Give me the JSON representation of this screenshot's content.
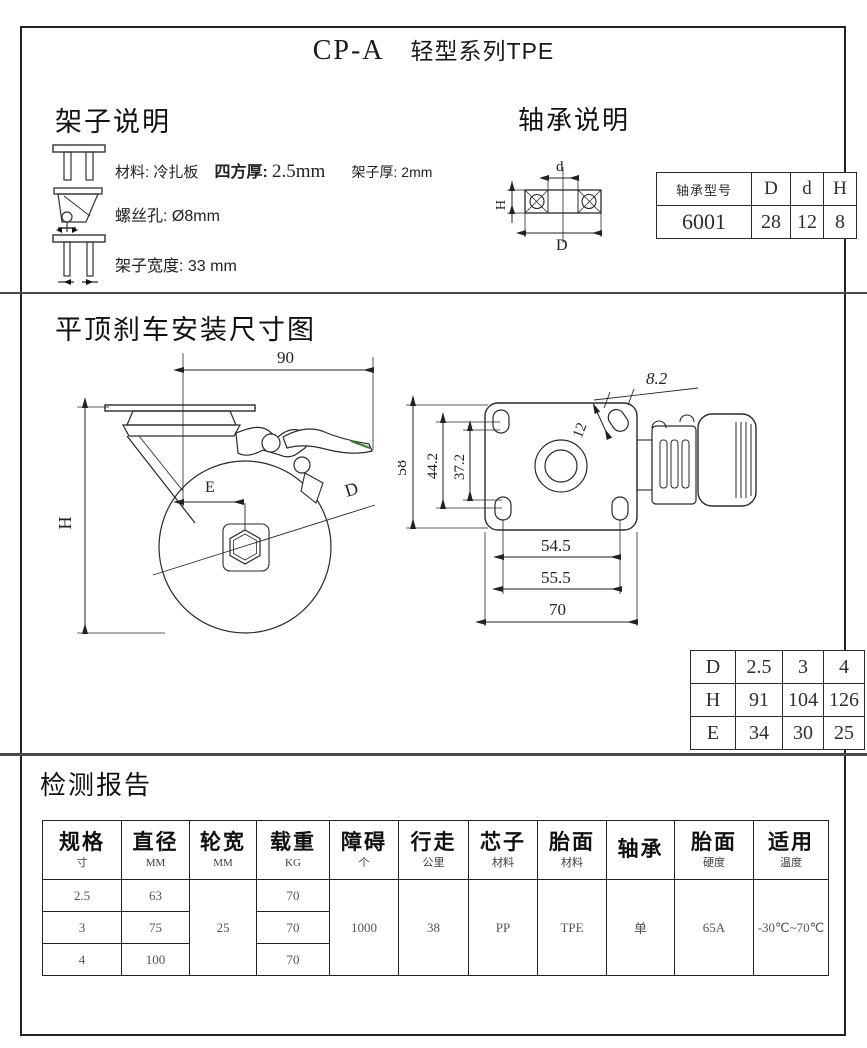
{
  "page": {
    "code": "CP-A",
    "series": "轻型系列TPE"
  },
  "frame": {
    "heading": "架子说明",
    "material_label": "材料: 冷扎板",
    "square_thickness_label": "四方厚:",
    "square_thickness_value": "2.5mm",
    "frame_thickness": "架子厚: 2mm",
    "screw_hole": "螺丝孔: Ø8mm",
    "frame_width": "架子宽度: 33 mm"
  },
  "bearing": {
    "heading": "轴承说明",
    "diagram": {
      "d": "d",
      "D": "D",
      "H": "H"
    },
    "table": {
      "model_header": "轴承型号",
      "col_D": "D",
      "col_d": "d",
      "col_H": "H",
      "model": "6001",
      "D_value": "28",
      "d_value": "12",
      "H_value": "8"
    }
  },
  "drawing": {
    "heading": "平顶刹车安装尺寸图",
    "side_view": {
      "width": "90",
      "height_label": "H",
      "offset_label": "E",
      "diameter_label": "D"
    },
    "top_view": {
      "plate_height": "58",
      "bolt_span_outer": "44.2",
      "bolt_span_inner": "37.2",
      "slot_length": "12",
      "slot_width": "8.2",
      "bolt_pitch_inner": "54.5",
      "bolt_pitch_outer": "55.5",
      "plate_width": "70"
    },
    "dhe_table": {
      "row_d": {
        "label": "D",
        "c1": "2.5",
        "c2": "3",
        "c3": "4"
      },
      "row_h": {
        "label": "H",
        "c1": "91",
        "c2": "104",
        "c3": "126"
      },
      "row_e": {
        "label": "E",
        "c1": "34",
        "c2": "30",
        "c3": "25"
      }
    }
  },
  "report": {
    "heading": "检测报告",
    "headers": [
      {
        "main": "规格",
        "sub": "寸"
      },
      {
        "main": "直径",
        "sub": "MM"
      },
      {
        "main": "轮宽",
        "sub": "MM"
      },
      {
        "main": "载重",
        "sub": "KG"
      },
      {
        "main": "障碍",
        "sub": "个"
      },
      {
        "main": "行走",
        "sub": "公里"
      },
      {
        "main": "芯子",
        "sub": "材料"
      },
      {
        "main": "胎面",
        "sub": "材料"
      },
      {
        "main": "轴承",
        "sub": ""
      },
      {
        "main": "胎面",
        "sub": "硬度"
      },
      {
        "main": "适用",
        "sub": "温度"
      }
    ],
    "rows": {
      "r1": {
        "spec": "2.5",
        "diameter": "63",
        "load": "70"
      },
      "r2": {
        "spec": "3",
        "diameter": "75",
        "load": "70"
      },
      "r3": {
        "spec": "4",
        "diameter": "100",
        "load": "70"
      }
    },
    "merged": {
      "wheel_width": "25",
      "obstacles": "1000",
      "distance": "38",
      "core_material": "PP",
      "tread_material": "TPE",
      "bearing_type": "单",
      "tread_hardness": "65A",
      "temperature": "-30℃~70℃"
    }
  }
}
